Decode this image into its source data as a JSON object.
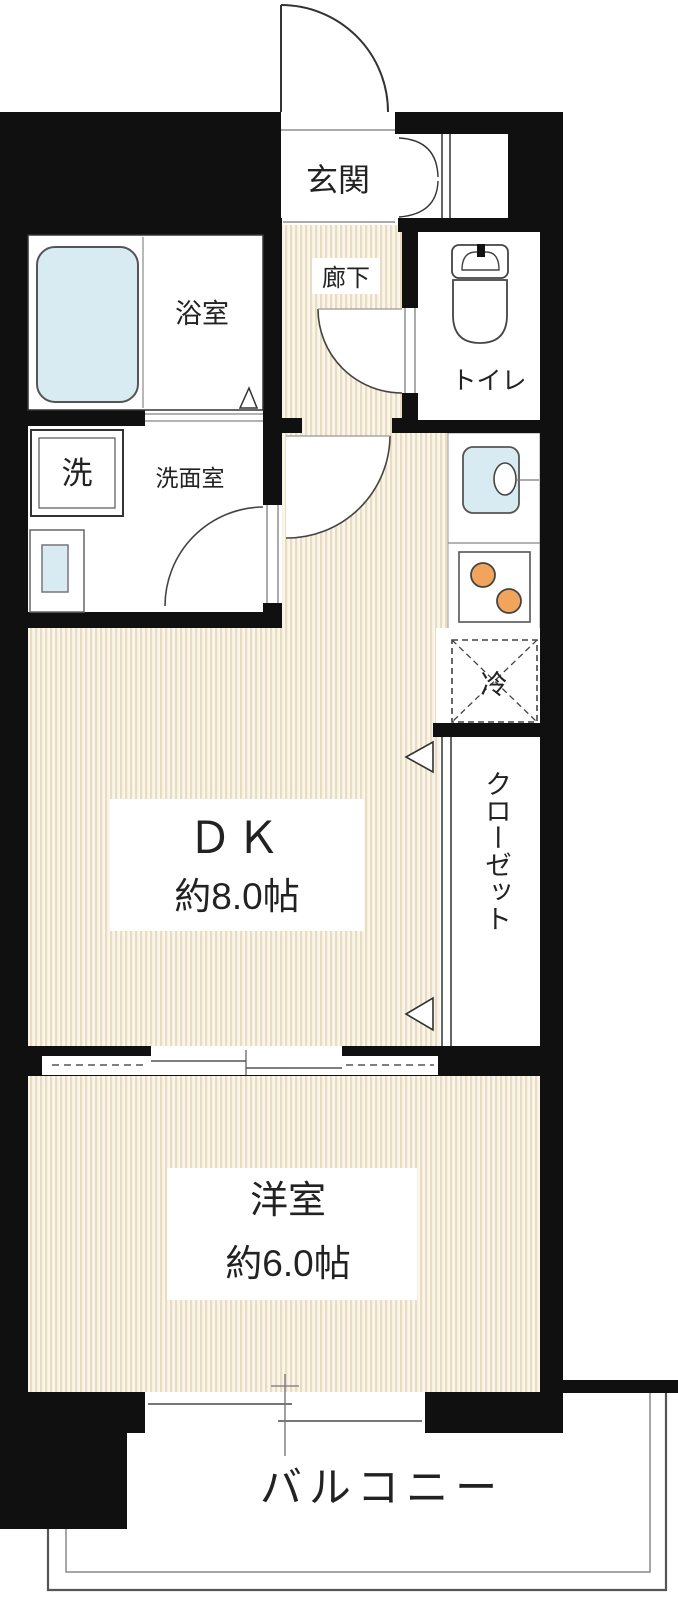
{
  "floorplan": {
    "title": "1DK apartment floor plan",
    "rooms": {
      "entrance": {
        "label": "玄関"
      },
      "corridor": {
        "label": "廊下"
      },
      "toilet": {
        "label": "トイレ"
      },
      "bathroom": {
        "label": "浴室"
      },
      "washer": {
        "label": "洗"
      },
      "washroom": {
        "label": "洗面室"
      },
      "dining_kitchen": {
        "label": "ＤＫ",
        "size": "約8.0帖"
      },
      "closet": {
        "label": "クローゼット"
      },
      "refrigerator": {
        "label": "冷"
      },
      "western_room": {
        "label": "洋室",
        "size": "約6.0帖"
      },
      "balcony": {
        "label": "バルコニー"
      }
    },
    "colors": {
      "wall": "#101010",
      "floor_base": "#faf6ec",
      "floor_stripe": "#e9dcc0",
      "water_blue": "#d8ebf2",
      "burner_orange": "#f1a45b",
      "line_gray": "#888888"
    }
  }
}
